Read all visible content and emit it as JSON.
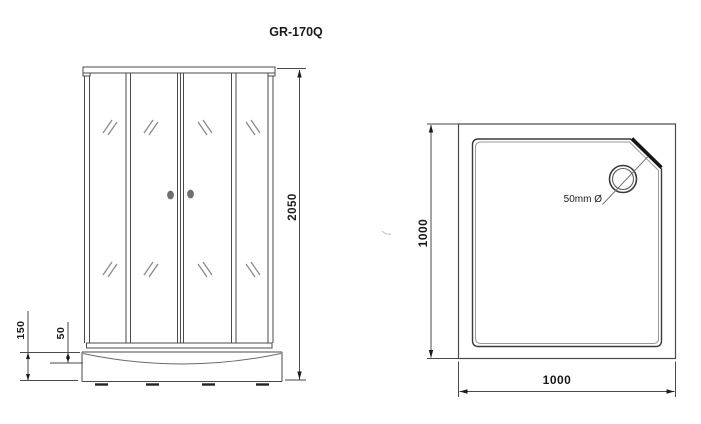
{
  "title": "GR-170Q",
  "front_view": {
    "description": "front elevation of shower cabin with sliding glass doors",
    "dims": {
      "height": "2050",
      "tray_height": "150",
      "tray_inner_depth": "50"
    }
  },
  "top_view": {
    "description": "plan view of square shower tray with corner drain",
    "dims": {
      "depth": "1000",
      "width": "1000"
    },
    "drain_label": "50mm Ø"
  },
  "colors": {
    "background": "#ffffff",
    "line": "#4a4a4a",
    "line_soft": "#8a8a8a",
    "line_dark": "#1c1c1c",
    "text": "#1a1a1a",
    "knob": "#6f6f6f"
  }
}
